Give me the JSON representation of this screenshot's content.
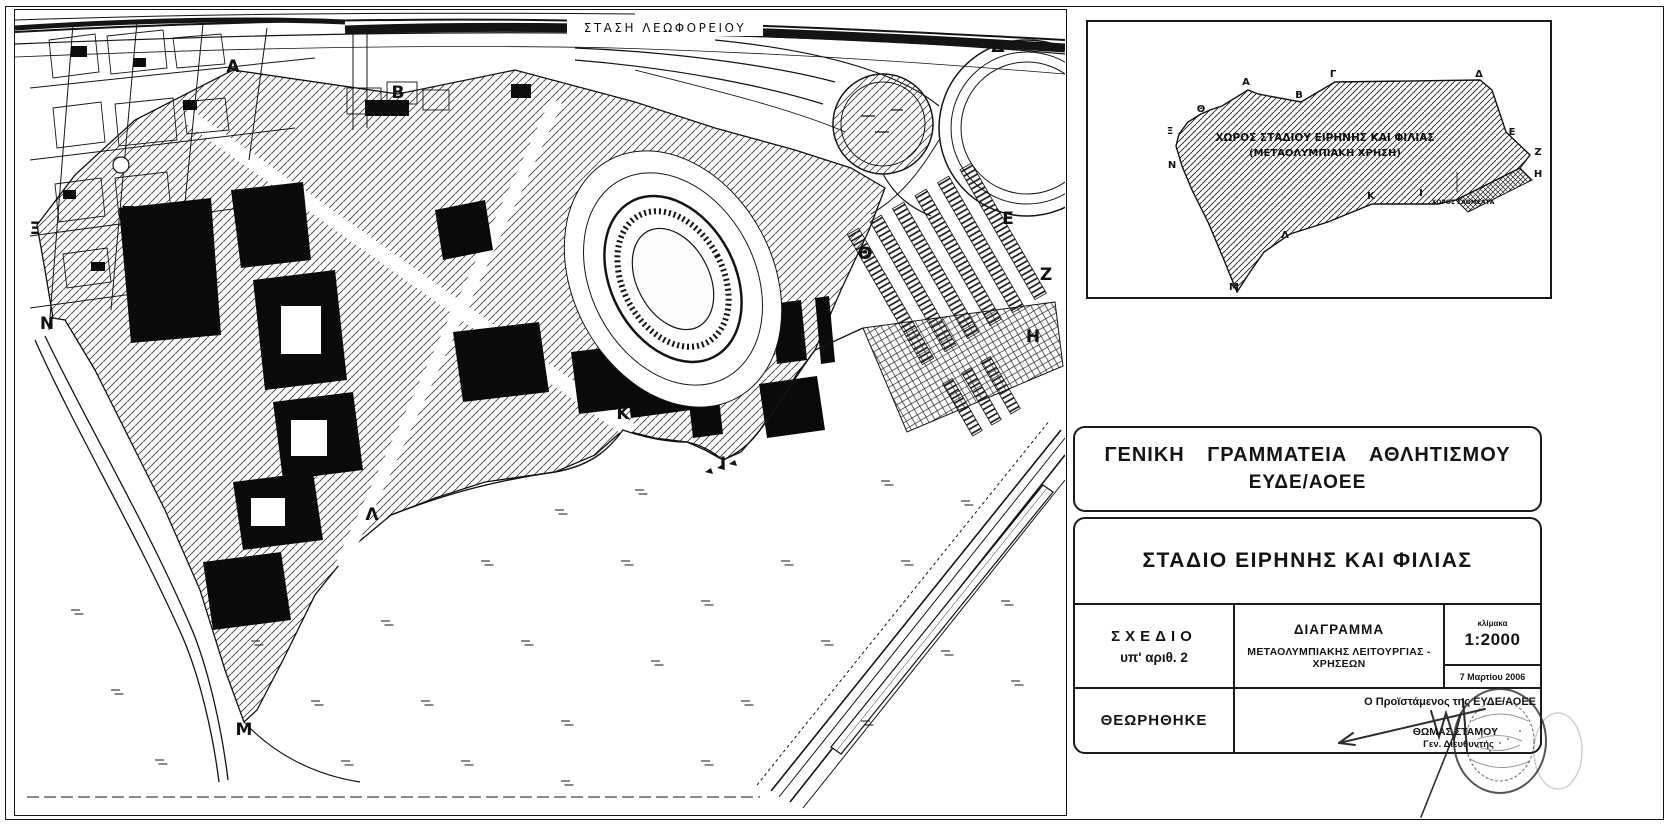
{
  "letters": {
    "alpha": "Α",
    "beta": "Β",
    "gamma": "Γ",
    "delta": "Δ",
    "epsilon": "Ε",
    "zeta": "Ζ",
    "eta": "Η",
    "theta": "Θ",
    "iota": "Ι",
    "kappa": "Κ",
    "lambda": "Λ",
    "mu": "Μ",
    "nu": "Ν",
    "xi": "Ξ"
  },
  "map": {
    "bus_stop_label": "ΣΤΑΣΗ ΛΕΩΦΟΡΕΙΟΥ"
  },
  "inset": {
    "area_line1": "ΧΩΡΟΣ ΣΤΑΔΙΟΥ ΕΙΡΗΝΗΣ ΚΑΙ ΦΙΛΙΑΣ",
    "area_line2": "(ΜΕΤΑΟΛΥΜΠΙΑΚΗ ΧΡΗΣΗ)",
    "side_label": "ΧΩΡΟΣ ΣΑΟΜΕΛΤΑ"
  },
  "title_block": {
    "org_line1": "ΓΕΝΙΚΗ ΓΡΑΜΜΑΤΕΙΑ ΑΘΛΗΤΙΣΜΟΥ",
    "org_line2": "ΕΥΔΕ/ΑΟΕΕ",
    "project_title": "ΣΤΑΔΙΟ ΕΙΡΗΝΗΣ ΚΑΙ ΦΙΛΙΑΣ",
    "drawing_label": "ΣΧΕΔΙΟ",
    "drawing_number": "υπ' αριθ. 2",
    "subject_title": "ΔΙΑΓΡΑΜΜΑ",
    "subject_subtitle": "ΜΕΤΑΟΛΥΜΠΙΑΚΗΣ ΛΕΙΤΟΥΡΓΙΑΣ - ΧΡΗΣΕΩΝ",
    "scale_label": "κλίμακα",
    "scale_value": "1:2000",
    "date": "7 Μαρτίου 2006",
    "approved_label": "ΘΕΩΡΗΘΗΚΕ",
    "signer_title": "Ο Προϊστάμενος της ΕΥΔΕ/ΑΟΕΕ",
    "signer_name": "ΘΩΜΑΣ ΣΤΑΜΟΥ",
    "signer_role": "Γεν. Διευθυντής"
  }
}
